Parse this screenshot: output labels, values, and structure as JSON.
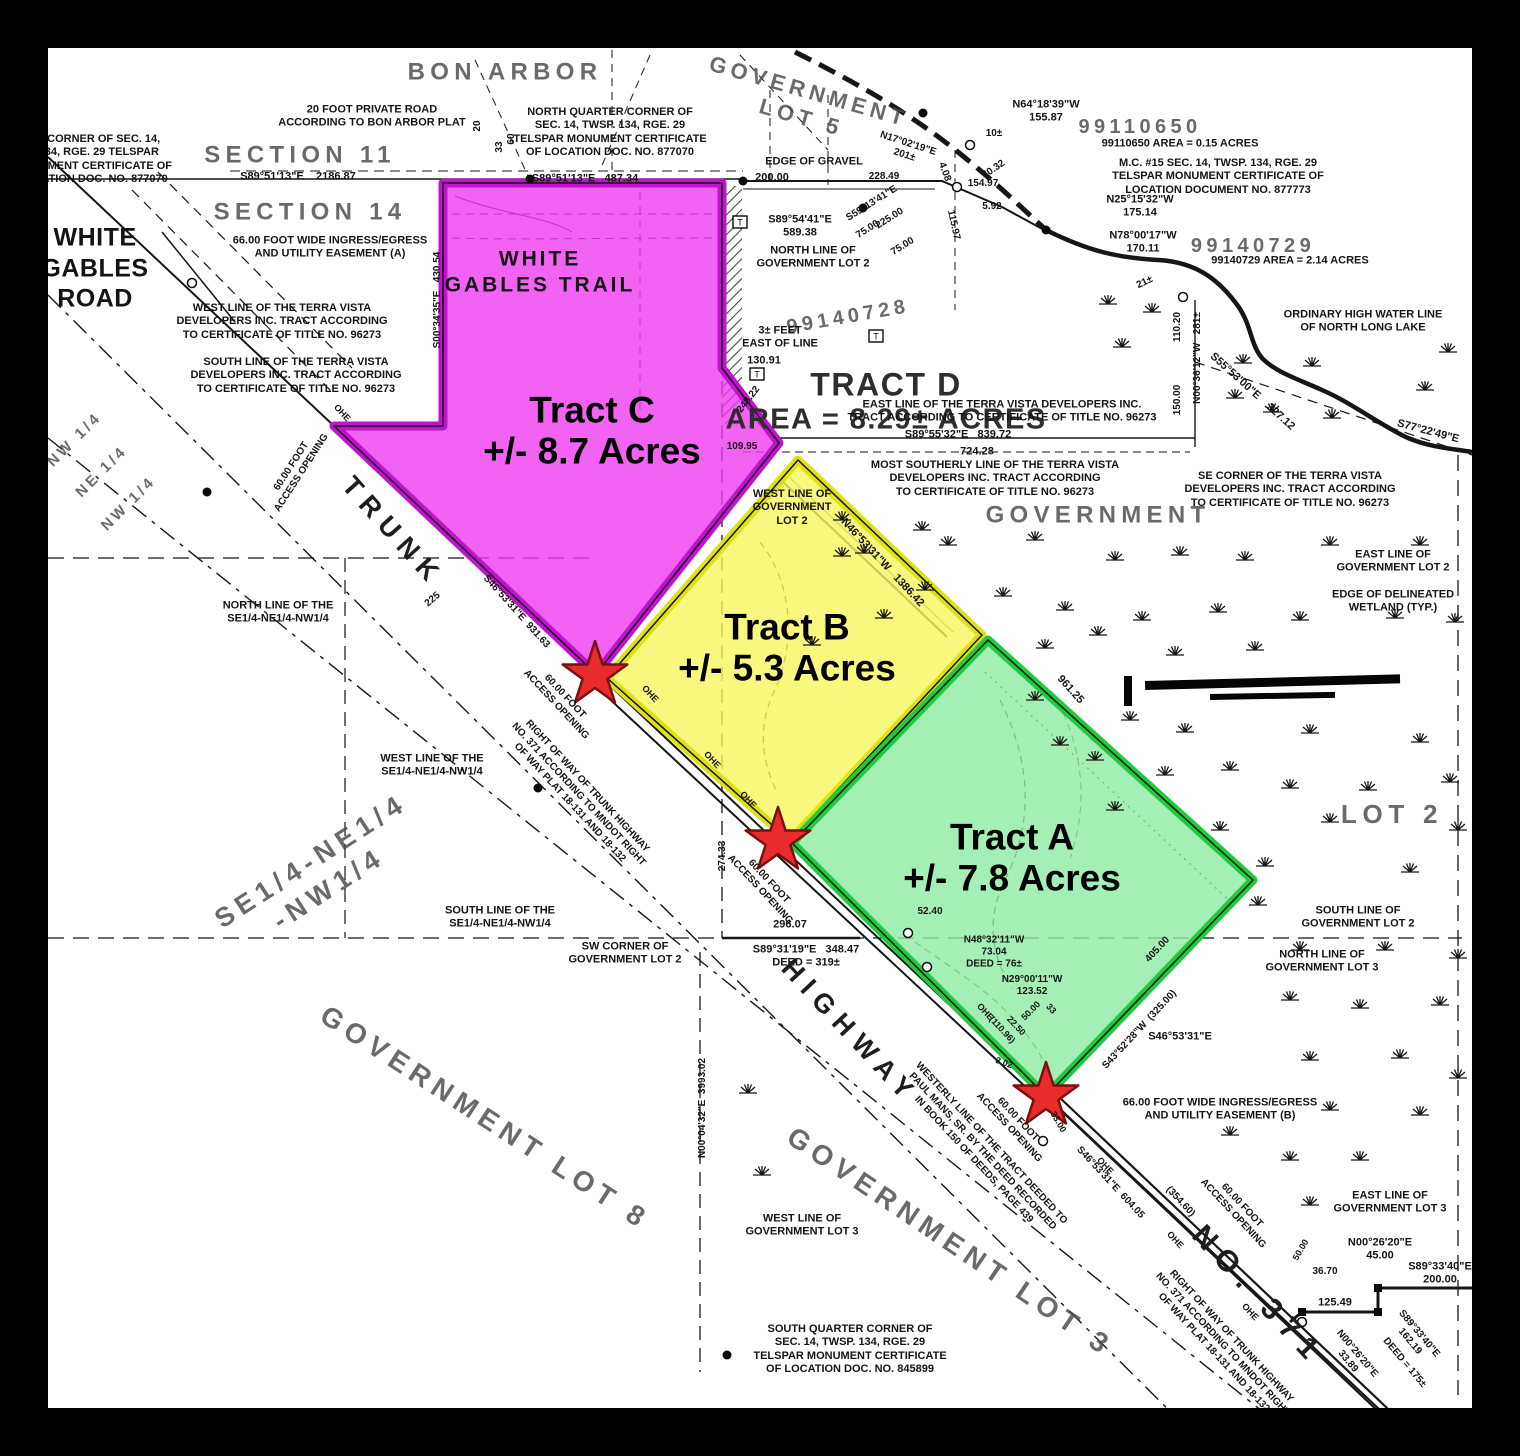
{
  "map_title": "Survey plat of Tracts A, B, C near Trunk Highway No. 371 and North Long Lake",
  "colors": {
    "frame": "#000000",
    "paper": "#ffffff",
    "ink": "#161616",
    "star_fill": "#e82b2b",
    "star_stroke": "#7a1010"
  },
  "tracts": [
    {
      "id": "tract-c",
      "name": "Tract C",
      "acres": "+/- 8.7 Acres",
      "fill": "#f03cf0",
      "stroke": "#c212cf",
      "points": "443,183 722,183 722,368 779,443 596,674 334,426 443,426",
      "label_x": 592,
      "label_y": 431
    },
    {
      "id": "tract-b",
      "name": "Tract B",
      "acres": "+/- 5.3 Acres",
      "fill": "#f7f65e",
      "stroke": "#dde312",
      "points": "798,460 982,635 790,841 607,678",
      "label_x": 787,
      "label_y": 648
    },
    {
      "id": "tract-a",
      "name": "Tract A",
      "acres": "+/- 7.8 Acres",
      "fill": "#8deba3",
      "stroke": "#1ecb3c",
      "points": "988,640 1253,880 1046,1096 792,843",
      "label_x": 1012,
      "label_y": 858
    }
  ],
  "stars": [
    {
      "x": 595,
      "y": 675
    },
    {
      "x": 778,
      "y": 841
    },
    {
      "x": 1046,
      "y": 1096
    }
  ],
  "labels": [
    [
      "NW CORNER OF SEC. 14,\nT. 134, RGE. 29 TELSPAR\nMONUMENT CERTIFICATE OF\nLOCATION DOC. NO. 877070",
      93,
      160,
      0,
      11,
      ""
    ],
    [
      "20 FOOT PRIVATE ROAD\nACCORDING TO BON ARBOR PLAT",
      372,
      117,
      0,
      11,
      ""
    ],
    [
      "NORTH QUARTER CORNER OF\nSEC. 14, TWSP. 134, RGE. 29\nTELSPAR MONUMENT CERTIFICATE\nOF LOCATION DOC. NO. 877070",
      610,
      133,
      0,
      11,
      ""
    ],
    [
      "BON ARBOR",
      505,
      72,
      0,
      24,
      "g"
    ],
    [
      "GOVERNMENT\nLOT 5",
      805,
      105,
      16,
      22,
      "g"
    ],
    [
      "SECTION 11",
      300,
      155,
      0,
      24,
      "g"
    ],
    [
      "SECTION 14",
      310,
      212,
      0,
      24,
      "g"
    ],
    [
      "S89°51'13\"E    2186.87",
      298,
      177,
      0,
      11,
      ""
    ],
    [
      "S89°51'13\"E   487.34",
      585,
      179,
      0,
      11,
      ""
    ],
    [
      "20",
      478,
      126,
      -90,
      10,
      ""
    ],
    [
      "33",
      500,
      147,
      -90,
      10,
      ""
    ],
    [
      "60",
      512,
      139,
      -90,
      10,
      ""
    ],
    [
      "66.00 FOOT WIDE INGRESS/EGRESS\nAND UTILITY EASEMENT (A)",
      330,
      248,
      0,
      11,
      ""
    ],
    [
      "WHITE\nGABLES\nROAD",
      95,
      268,
      0,
      25,
      "r"
    ],
    [
      "EDGE OF GRAVEL",
      814,
      162,
      0,
      11,
      ""
    ],
    [
      "200.00",
      772,
      178,
      0,
      11,
      ""
    ],
    [
      "S89°54'41\"E\n589.38",
      800,
      227,
      0,
      11,
      ""
    ],
    [
      "NORTH LINE OF\nGOVERNMENT LOT 2",
      813,
      258,
      0,
      11,
      ""
    ],
    [
      "N17°02'19\"E\n201±",
      906,
      150,
      18,
      10,
      ""
    ],
    [
      "228.49",
      884,
      177,
      0,
      10,
      ""
    ],
    [
      "S59°13'41\"E",
      872,
      204,
      -32,
      10,
      ""
    ],
    [
      "225.00",
      890,
      219,
      -32,
      10,
      ""
    ],
    [
      "75.00",
      868,
      230,
      -32,
      10,
      ""
    ],
    [
      "75.00",
      903,
      247,
      -32,
      10,
      ""
    ],
    [
      "10±",
      994,
      134,
      0,
      10,
      ""
    ],
    [
      "N64°18'39\"W\n155.87",
      1046,
      112,
      0,
      11,
      ""
    ],
    [
      "99110650",
      1140,
      127,
      0,
      20,
      "g"
    ],
    [
      "99110650 AREA = 0.15 ACRES",
      1180,
      144,
      0,
      11,
      ""
    ],
    [
      "4.08",
      944,
      172,
      70,
      10,
      ""
    ],
    [
      "70.32",
      994,
      170,
      -35,
      10,
      ""
    ],
    [
      "154.97",
      983,
      184,
      0,
      10,
      ""
    ],
    [
      "5.92",
      992,
      207,
      0,
      10,
      ""
    ],
    [
      "115.97",
      953,
      225,
      78,
      10,
      ""
    ],
    [
      "M.C. #15 SEC. 14, TWSP. 134, RGE. 29\nTELSPAR MONUMENT CERTIFICATE OF\nLOCATION DOCUMENT NO. 877773",
      1218,
      177,
      0,
      11,
      ""
    ],
    [
      "N25°15'32\"W\n175.14",
      1140,
      207,
      0,
      11,
      ""
    ],
    [
      "N78°00'17\"W\n170.11",
      1143,
      243,
      0,
      11,
      ""
    ],
    [
      "99140729",
      1253,
      246,
      0,
      20,
      "g"
    ],
    [
      "99140729 AREA = 2.14 ACRES",
      1290,
      261,
      0,
      11,
      ""
    ],
    [
      "21±",
      1145,
      283,
      -25,
      10,
      ""
    ],
    [
      "99140728",
      848,
      317,
      -10,
      20,
      "g"
    ],
    [
      "WEST LINE OF THE TERRA VISTA\nDEVELOPERS INC. TRACT ACCORDING\nTO CERTIFICATE OF TITLE NO. 96273",
      282,
      322,
      0,
      11,
      ""
    ],
    [
      "SOUTH LINE OF THE TERRA VISTA\nDEVELOPERS INC. TRACT ACCORDING\nTO CERTIFICATE OF TITLE NO. 96273",
      296,
      376,
      0,
      11,
      ""
    ],
    [
      "3± FEET\nEAST OF LINE",
      780,
      338,
      0,
      11,
      ""
    ],
    [
      "130.91",
      764,
      361,
      0,
      11,
      ""
    ],
    [
      "S00°34'35\"E   430.54",
      438,
      300,
      -90,
      10,
      ""
    ],
    [
      "WHITE\nGABLES TRAIL",
      540,
      272,
      0,
      21,
      "w"
    ],
    [
      "TRACT D",
      886,
      385,
      0,
      32,
      "d"
    ],
    [
      "AREA = 8.29± ACRES",
      886,
      420,
      0,
      29,
      "d"
    ],
    [
      "EAST LINE OF THE TERRA VISTA DEVELOPERS INC.\nTRACT ACCORDING TO CERTIFICATE OF TITLE NO. 96273",
      1002,
      412,
      0,
      11,
      ""
    ],
    [
      "S89°55'32\"E   839.72",
      958,
      435,
      0,
      11,
      ""
    ],
    [
      "724.28",
      977,
      452,
      0,
      11,
      ""
    ],
    [
      "MOST SOUTHERLY LINE OF THE TERRA VISTA\nDEVELOPERS INC. TRACT ACCORDING\nTO CERTIFICATE OF TITLE NO. 96273",
      995,
      479,
      0,
      11,
      ""
    ],
    [
      "SE CORNER OF THE TERRA VISTA\nDEVELOPERS INC. TRACT ACCORDING\nTO CERTIFICATE OF TITLE NO. 96273",
      1290,
      490,
      0,
      11,
      ""
    ],
    [
      "ORDINARY HIGH WATER LINE\nOF NORTH LONG LAKE",
      1363,
      322,
      0,
      11,
      ""
    ],
    [
      "110.20",
      1178,
      327,
      -90,
      10,
      ""
    ],
    [
      "N00°36'12\"W   281±",
      1198,
      358,
      -90,
      10,
      ""
    ],
    [
      "150.00",
      1178,
      400,
      -90,
      10,
      ""
    ],
    [
      "S55°53'00\"E    327.12",
      1252,
      392,
      42,
      11,
      ""
    ],
    [
      "S77°22'49\"E",
      1428,
      432,
      15,
      11,
      ""
    ],
    [
      "GOVERNMENT",
      1098,
      515,
      0,
      24,
      "g"
    ],
    [
      "EAST LINE OF\nGOVERNMENT LOT 2",
      1393,
      562,
      0,
      11,
      ""
    ],
    [
      "EDGE OF DELINEATED\nWETLAND (TYP.)",
      1393,
      602,
      0,
      11,
      ""
    ],
    [
      "248.22",
      749,
      400,
      -52,
      10,
      ""
    ],
    [
      "109.95",
      742,
      447,
      0,
      10,
      ""
    ],
    [
      "WEST LINE OF\nGOVERNMENT\nLOT 2",
      792,
      508,
      0,
      11,
      ""
    ],
    [
      "N46°53'31\"W   1386.42",
      882,
      563,
      47,
      11,
      ""
    ],
    [
      "NORTH LINE OF THE\nSE1/4-NE1/4-NW1/4",
      278,
      613,
      0,
      11,
      ""
    ],
    [
      "225",
      433,
      600,
      -40,
      10,
      ""
    ],
    [
      "TRUNK",
      393,
      532,
      48,
      27,
      "h"
    ],
    [
      "S46°53'31\"E  931.63",
      516,
      612,
      48,
      10,
      ""
    ],
    [
      "60.00 FOOT\nACCESS OPENING",
      297,
      470,
      -57,
      10,
      ""
    ],
    [
      "60.00 FOOT\nACCESS OPENING",
      560,
      701,
      47,
      10,
      ""
    ],
    [
      "60.00 FOOT\nACCESS OPENING",
      764,
      886,
      47,
      10,
      ""
    ],
    [
      "60.00 FOOT\nACCESS OPENING",
      1013,
      1124,
      47,
      10,
      ""
    ],
    [
      "60.00 FOOT\nACCESS OPENING",
      1237,
      1210,
      47,
      10,
      ""
    ],
    [
      "OHE",
      342,
      413,
      47,
      9,
      ""
    ],
    [
      "OHE",
      650,
      694,
      47,
      9,
      ""
    ],
    [
      "OHE",
      712,
      760,
      47,
      9,
      ""
    ],
    [
      "OHE",
      748,
      800,
      47,
      9,
      ""
    ],
    [
      "OHE",
      985,
      1012,
      47,
      9,
      ""
    ],
    [
      "(110.96)",
      1002,
      1030,
      47,
      9,
      ""
    ],
    [
      "OHE",
      1105,
      1166,
      47,
      9,
      ""
    ],
    [
      "OHE",
      1175,
      1240,
      47,
      9,
      ""
    ],
    [
      "OHE",
      1250,
      1312,
      47,
      9,
      ""
    ],
    [
      "NW 1/4",
      75,
      440,
      -45,
      15,
      "g"
    ],
    [
      "NE 1/4",
      102,
      472,
      -45,
      15,
      "g"
    ],
    [
      "NW 1/4",
      129,
      504,
      -45,
      15,
      "g"
    ],
    [
      "WEST LINE OF THE\nSE1/4-NE1/4-NW1/4",
      432,
      766,
      0,
      11,
      ""
    ],
    [
      "SE1/4-NE1/4\n-NW1/4",
      320,
      875,
      -33,
      27,
      "g"
    ],
    [
      "SOUTH LINE OF THE\nSE1/4-NE1/4-NW1/4",
      500,
      918,
      0,
      11,
      ""
    ],
    [
      "RIGHT OF WAY OF TRUNK HIGHWAY\nNO. 371 ACCORDING TO MNDOT RIGHT\nOF WAY PLAT 18-131 AND 18-132",
      578,
      795,
      47,
      10,
      ""
    ],
    [
      "SW CORNER OF\nGOVERNMENT LOT 2",
      625,
      954,
      0,
      11,
      ""
    ],
    [
      "274.33",
      723,
      856,
      -90,
      10,
      ""
    ],
    [
      "296.07",
      790,
      925,
      0,
      11,
      ""
    ],
    [
      "S89°31'19\"E   348.47\nDEED = 319±",
      806,
      957,
      0,
      11,
      ""
    ],
    [
      "HIGHWAY",
      850,
      1032,
      47,
      27,
      "h"
    ],
    [
      "GOVERNMENT LOT 8",
      485,
      1118,
      33,
      28,
      "g"
    ],
    [
      "N00°04'32\"E  3993.02",
      703,
      1108,
      -90,
      10,
      ""
    ],
    [
      "52.40",
      930,
      912,
      0,
      10,
      ""
    ],
    [
      "N48°32'11\"W\n73.04\nDEED = 76±",
      994,
      953,
      0,
      10,
      ""
    ],
    [
      "N29°00'11\"W\n123.52",
      1032,
      986,
      0,
      10,
      ""
    ],
    [
      "50.00",
      1031,
      1011,
      -45,
      9,
      ""
    ],
    [
      "22.50",
      1016,
      1026,
      47,
      9,
      ""
    ],
    [
      "33",
      1051,
      1009,
      47,
      9,
      ""
    ],
    [
      "3.02",
      1004,
      1063,
      20,
      9,
      ""
    ],
    [
      "33.00",
      1058,
      1122,
      60,
      9,
      ""
    ],
    [
      "WESTERLY LINE OF THE TRACT DEEDED TO\nPAUL MANS, SR. BY THE DEED RECORDED\nIN BOOK 150 OF DEEDS, PAGE 439",
      982,
      1152,
      47,
      10,
      ""
    ],
    [
      "S43°52'28\"W  (325.00)",
      1140,
      1030,
      -47,
      10,
      ""
    ],
    [
      "405.00",
      1158,
      950,
      -47,
      10,
      ""
    ],
    [
      "S46°53'31\"E",
      1180,
      1037,
      0,
      11,
      ""
    ],
    [
      "66.00 FOOT WIDE INGRESS/EGRESS\nAND UTILITY EASEMENT (B)",
      1220,
      1110,
      0,
      11,
      ""
    ],
    [
      "SOUTH LINE OF\nGOVERNMENT LOT 2",
      1358,
      918,
      0,
      11,
      ""
    ],
    [
      "NORTH LINE OF\nGOVERNMENT LOT 3",
      1322,
      962,
      0,
      11,
      ""
    ],
    [
      "LOT 2",
      1392,
      815,
      0,
      26,
      "g"
    ],
    [
      "961.25",
      1070,
      690,
      48,
      11,
      ""
    ],
    [
      "WEST LINE OF\nGOVERNMENT LOT 3",
      802,
      1226,
      0,
      11,
      ""
    ],
    [
      "GOVERNMENT LOT 3",
      950,
      1242,
      34,
      28,
      "g"
    ],
    [
      "SOUTH QUARTER CORNER OF\nSEC. 14, TWSP. 134, RGE. 29\nTELSPAR MONUMENT CERTIFICATE\nOF LOCATION DOC. NO. 845899",
      850,
      1350,
      0,
      11,
      ""
    ],
    [
      "S46°53'31\"E  604.05",
      1110,
      1183,
      47,
      10,
      ""
    ],
    [
      "(354.60)",
      1180,
      1202,
      47,
      10,
      ""
    ],
    [
      "NO. 371",
      1258,
      1296,
      47,
      30,
      "h"
    ],
    [
      "RIGHT OF WAY OF TRUNK HIGHWAY\nNO. 371 ACCORDING TO MNDOT RIGHT\nOF WAY PLAT 18-131 AND 18-132",
      1222,
      1345,
      47,
      10,
      ""
    ],
    [
      "EAST LINE OF\nGOVERNMENT LOT 3",
      1390,
      1203,
      0,
      11,
      ""
    ],
    [
      "N00°26'20\"E\n45.00",
      1380,
      1250,
      0,
      11,
      ""
    ],
    [
      "S89°33'40\"E\n200.00",
      1440,
      1274,
      0,
      11,
      ""
    ],
    [
      "36.70",
      1325,
      1272,
      0,
      10,
      ""
    ],
    [
      "50.00",
      1301,
      1250,
      -60,
      9,
      ""
    ],
    [
      "125.49",
      1335,
      1303,
      0,
      11,
      ""
    ],
    [
      "N00°26'20\"E\n33.89",
      1352,
      1358,
      50,
      10,
      ""
    ],
    [
      "DEED = 175±",
      1404,
      1363,
      50,
      10,
      ""
    ],
    [
      "S89°33'40\"E\n162.19",
      1414,
      1338,
      50,
      10,
      ""
    ]
  ],
  "markers": {
    "dots": [
      [
        530,
        179
      ],
      [
        743,
        181
      ],
      [
        863,
        208
      ],
      [
        923,
        113
      ],
      [
        1046,
        230
      ],
      [
        727,
        1355
      ],
      [
        538,
        788
      ],
      [
        207,
        492
      ]
    ],
    "squares": [
      [
        1378,
        1312
      ],
      [
        1378,
        1288
      ],
      [
        1302,
        1312
      ]
    ],
    "circles": [
      [
        970,
        145
      ],
      [
        957,
        187
      ],
      [
        1183,
        297
      ],
      [
        1302,
        1322
      ],
      [
        908,
        933
      ],
      [
        927,
        967
      ],
      [
        1043,
        1141
      ],
      [
        192,
        283
      ]
    ],
    "tboxes": [
      [
        740,
        222
      ],
      [
        757,
        374
      ],
      [
        876,
        336
      ]
    ]
  },
  "tufts": [
    [
      1108,
      304
    ],
    [
      1152,
      312
    ],
    [
      1122,
      347
    ],
    [
      1243,
      363
    ],
    [
      1312,
      366
    ],
    [
      1235,
      398
    ],
    [
      1272,
      412
    ],
    [
      1332,
      418
    ],
    [
      1425,
      390
    ],
    [
      1448,
      352
    ],
    [
      842,
      520
    ],
    [
      864,
      553
    ],
    [
      922,
      530
    ],
    [
      948,
      545
    ],
    [
      1035,
      540
    ],
    [
      1115,
      560
    ],
    [
      1180,
      555
    ],
    [
      1245,
      560
    ],
    [
      1330,
      545
    ],
    [
      1420,
      545
    ],
    [
      1003,
      596
    ],
    [
      1065,
      610
    ],
    [
      1142,
      620
    ],
    [
      1218,
      612
    ],
    [
      1300,
      620
    ],
    [
      1395,
      618
    ],
    [
      1455,
      622
    ],
    [
      925,
      590
    ],
    [
      1045,
      648
    ],
    [
      1098,
      635
    ],
    [
      1175,
      655
    ],
    [
      1255,
      650
    ],
    [
      1130,
      720
    ],
    [
      1185,
      732
    ],
    [
      1310,
      733
    ],
    [
      1420,
      742
    ],
    [
      1165,
      775
    ],
    [
      1230,
      770
    ],
    [
      1290,
      788
    ],
    [
      1368,
      790
    ],
    [
      1450,
      782
    ],
    [
      1220,
      830
    ],
    [
      1330,
      822
    ],
    [
      1458,
      830
    ],
    [
      1265,
      866
    ],
    [
      1410,
      872
    ],
    [
      1258,
      905
    ],
    [
      1300,
      950
    ],
    [
      1385,
      950
    ],
    [
      1458,
      958
    ],
    [
      1290,
      1000
    ],
    [
      1360,
      1008
    ],
    [
      1440,
      1005
    ],
    [
      1310,
      1060
    ],
    [
      1400,
      1058
    ],
    [
      1458,
      1078
    ],
    [
      1330,
      1110
    ],
    [
      1420,
      1115
    ],
    [
      1290,
      1160
    ],
    [
      1360,
      1160
    ],
    [
      1230,
      1135
    ],
    [
      1310,
      1205
    ],
    [
      842,
      556
    ],
    [
      884,
      618
    ],
    [
      812,
      645
    ],
    [
      1035,
      700
    ],
    [
      1060,
      745
    ],
    [
      1095,
      760
    ],
    [
      1115,
      810
    ],
    [
      748,
      1093
    ],
    [
      762,
      1175
    ]
  ],
  "redactions": [
    [
      1124,
      676,
      8,
      30,
      0
    ],
    [
      1145,
      681,
      255,
      9,
      -1.5
    ],
    [
      1210,
      694,
      125,
      6,
      -1
    ]
  ]
}
